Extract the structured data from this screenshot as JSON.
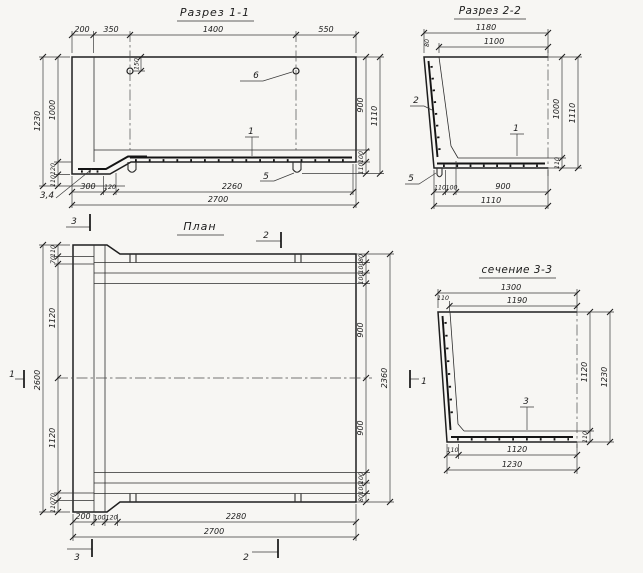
{
  "drawing": {
    "razrez11": {
      "title": "Разрез 1-1",
      "dims": {
        "top": [
          "200",
          "350",
          "1400",
          "550"
        ],
        "hole_offset": "150",
        "left_outer": "1230",
        "left_chain": [
          "1000",
          "120",
          "110"
        ],
        "right_chain": [
          "900",
          "100",
          "110"
        ],
        "right_outer": "1110",
        "bottom_chain": [
          "300",
          "120",
          "2260"
        ],
        "bottom_outer": "2700"
      },
      "labels": {
        "item1": "1",
        "item34": "3,4",
        "item5": "5",
        "item6": "6"
      }
    },
    "razrez22": {
      "title": "Разрез 2-2",
      "dims": {
        "top_outer": "1180",
        "top_inner": "1100",
        "top_small": "80",
        "right_inner": "1000",
        "right_small": "110",
        "right_outer": "1110",
        "bottom_chain": [
          "110",
          "100",
          "900"
        ],
        "bottom_outer": "1110"
      },
      "labels": {
        "item1": "1",
        "item2": "2",
        "item5": "5"
      }
    },
    "plan": {
      "title": "План",
      "dims": {
        "left_outer": "2600",
        "left_chain": [
          "110",
          "70",
          "1120",
          "1120",
          "70",
          "110"
        ],
        "right_chain": [
          "80",
          "100",
          "100",
          "900",
          "900",
          "100",
          "100",
          "80"
        ],
        "right_outer": "2360",
        "bottom_chain": [
          "200",
          "100",
          "120",
          "2280"
        ],
        "bottom_outer": "2700"
      },
      "markers": {
        "m1": "1",
        "m2": "2",
        "m3": "3"
      }
    },
    "sechenie33": {
      "title": "сечение 3-3",
      "dims": {
        "top_outer": "1300",
        "top_inner": "1190",
        "top_small": "110",
        "right_inner": "1120",
        "right_small": "110",
        "right_outer": "1230",
        "bottom_small": "110",
        "bottom_inner": "1120",
        "bottom_outer": "1230"
      },
      "labels": {
        "item3": "3"
      }
    }
  }
}
